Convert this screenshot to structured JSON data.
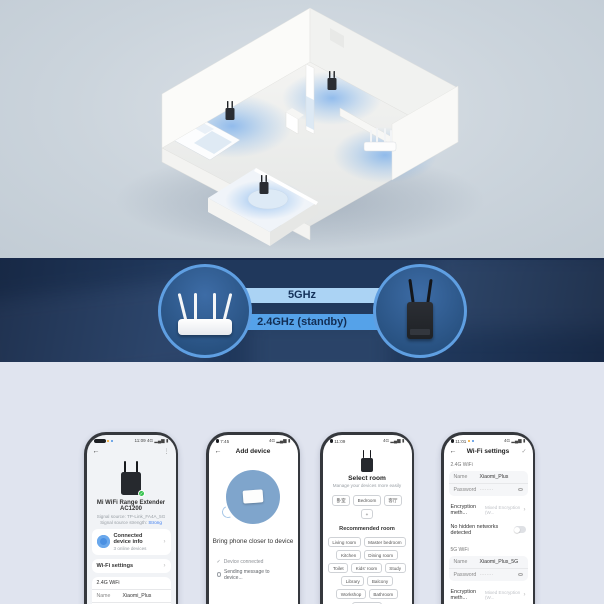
{
  "colors": {
    "hero_bg": "#cbd4dc",
    "banner_bg": "#20385c",
    "bar_top": "#abd3f4",
    "bar_bottom": "#55a2e9",
    "bar_text": "#14315a",
    "circle_border": "#5f9fe2",
    "accent_blue": "#3a7bf0",
    "badge_green": "#35c24d",
    "section_bg": "#e0e4ef"
  },
  "icons": {
    "back": "←",
    "menu": "⋮",
    "chevron": "›",
    "check": "✓",
    "status": "4G ▂▄▆ ▮"
  },
  "banner": {
    "top_label": "5GHz",
    "bottom_label": "2.4GHz (standby)"
  },
  "phone1": {
    "status_right": "11:09 4G ▂▄▆ ▮",
    "device_name": "Mi WiFi Range Extender AC1200",
    "signal_source": "Signal source: TP-Link_FA4A_5G",
    "signal_strength_label": "Signal source strength:",
    "signal_strength_value": "Strong",
    "card_title": "Connected device info",
    "card_subtitle": "3 online devices",
    "wifi_settings_label": "Wi-Fi settings",
    "band_label": "2.4G WiFi",
    "name_label": "Name",
    "name_value": "Xiaomi_Plus",
    "password_label": "Password",
    "password_value": "········"
  },
  "phone2": {
    "status_left": "7:45",
    "status_right": "4G ▂▄▆ ▮",
    "title": "Add device",
    "instruction": "Bring phone closer to device",
    "step1": "Device connected",
    "step2": "Sending message to device..."
  },
  "phone3": {
    "status_left": "11:09",
    "status_right": "4G ▂▄▆ ▮",
    "title": "Select room",
    "subtitle": "Manage your devices more easily",
    "my_rooms": [
      "卧室",
      "Bedroom",
      "客厅",
      "+"
    ],
    "recommended_label": "Recommended room",
    "recommended": [
      "Living room",
      "Master bedroom",
      "Kitchen",
      "Dining room",
      "Toilet",
      "Kids' room",
      "Study",
      "Library",
      "Balcony",
      "Workshop",
      "Bathroom",
      "Back yard"
    ]
  },
  "phone4": {
    "status_left": "11:01",
    "status_right": "4G ▂▄▆ ▮",
    "title": "Wi-Fi settings",
    "band24_label": "2.4G WiFi",
    "name_label": "Name",
    "name24_value": "Xiaomi_Plus",
    "password_label": "Password",
    "password_value": "········",
    "encryption_label": "Encryption meth...",
    "encryption_value": "Mixed Encryption (W...",
    "hidden_label": "No hidden networks detected",
    "band5_label": "5G WiFi",
    "name5_value": "Xiaomi_Plus_5G"
  }
}
